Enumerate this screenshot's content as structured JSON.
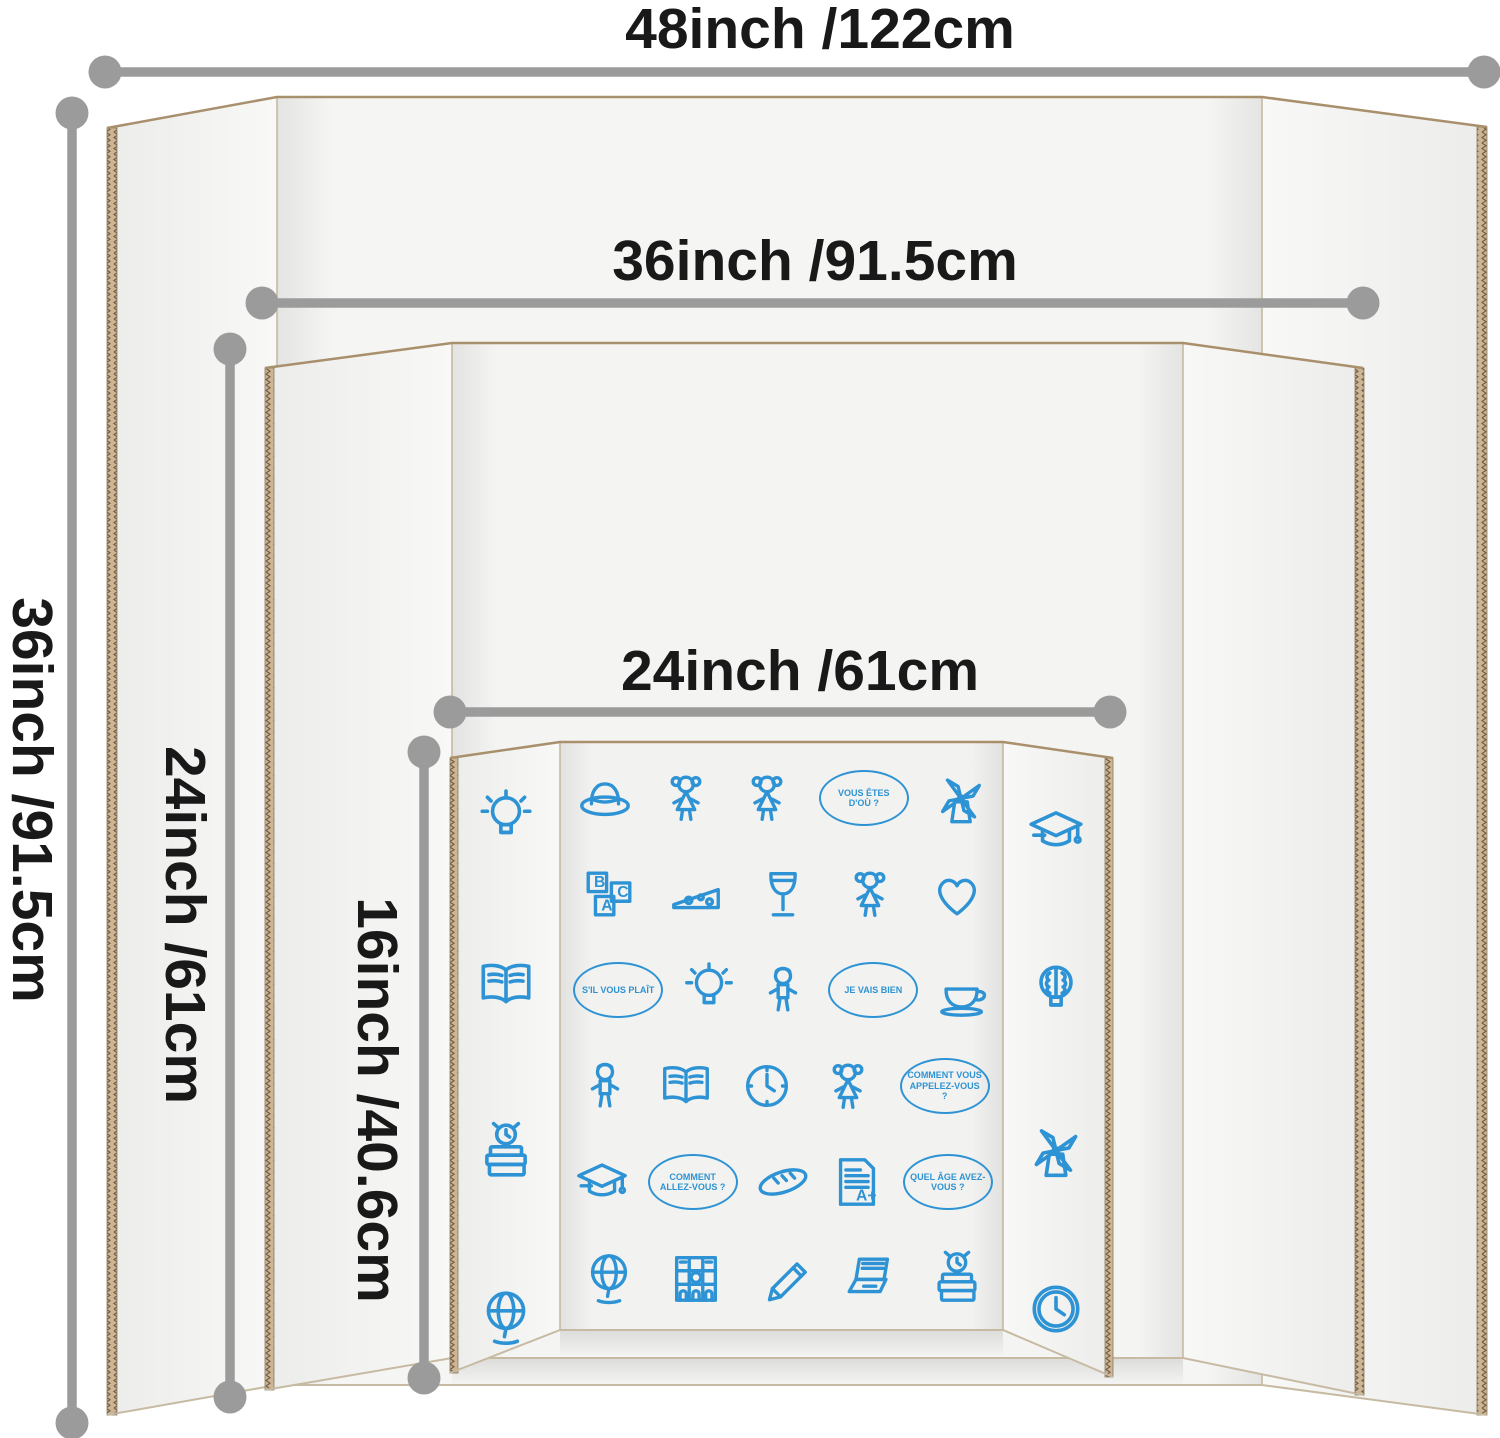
{
  "dimensions": {
    "horizontal": [
      {
        "label": "48inch /122cm"
      },
      {
        "label": "36inch /91.5cm"
      },
      {
        "label": "24inch /61cm"
      }
    ],
    "vertical": [
      {
        "label": "36inch /91.5cm"
      },
      {
        "label": "24inch /61cm"
      },
      {
        "label": "16inch /40.6cm"
      }
    ]
  },
  "boards": [
    {
      "name": "large-trifold-board",
      "width_label": "48inch /122cm",
      "height_label": "36inch /91.5cm"
    },
    {
      "name": "medium-trifold-board",
      "width_label": "36inch /91.5cm",
      "height_label": "24inch /61cm"
    },
    {
      "name": "small-trifold-board",
      "width_label": "24inch /61cm",
      "height_label": "16inch /40.6cm"
    }
  ],
  "colors": {
    "doodle_blue": "#2e93d4",
    "dimension_gray": "#9b9b9b",
    "label_text": "#191919",
    "cardboard_tan": "#cdb493",
    "board_face": "#f4f4f2"
  },
  "doodle_board": {
    "left_wing": [
      "lightbulb",
      "open-book",
      "alarm-books",
      "globe"
    ],
    "center_rows": [
      [
        {
          "icon": "hat"
        },
        {
          "icon": "girl"
        },
        {
          "icon": "girl"
        },
        {
          "bubble": "VOUS ÊTES D'OÙ ?"
        },
        {
          "icon": "windmill"
        }
      ],
      [
        {
          "icon": "abc-blocks"
        },
        {
          "icon": "cheese"
        },
        {
          "icon": "wine-glass"
        },
        {
          "icon": "girl"
        },
        {
          "icon": "heart"
        }
      ],
      [
        {
          "bubble": "S'IL VOUS PLAÎT"
        },
        {
          "icon": "lightbulb"
        },
        {
          "icon": "boy"
        },
        {
          "bubble": "JE VAIS BIEN"
        },
        {
          "icon": "teacup"
        }
      ],
      [
        {
          "icon": "boy"
        },
        {
          "icon": "open-book"
        },
        {
          "icon": "clock"
        },
        {
          "icon": "girl"
        },
        {
          "bubble": "COMMENT VOUS APPELEZ-VOUS ?"
        }
      ],
      [
        {
          "icon": "grad-cap"
        },
        {
          "bubble": "COMMENT ALLEZ-VOUS ?"
        },
        {
          "icon": "baguette"
        },
        {
          "icon": "document"
        },
        {
          "bubble": "QUEL ÂGE AVEZ-VOUS ?"
        }
      ],
      [
        {
          "icon": "globe"
        },
        {
          "icon": "notre-dame"
        },
        {
          "icon": "pencil"
        },
        {
          "icon": "laptop"
        },
        {
          "icon": "alarm-books"
        }
      ]
    ],
    "right_wing": [
      "grad-cap",
      "brain-bulb",
      "windmill",
      "wall-clock"
    ]
  }
}
